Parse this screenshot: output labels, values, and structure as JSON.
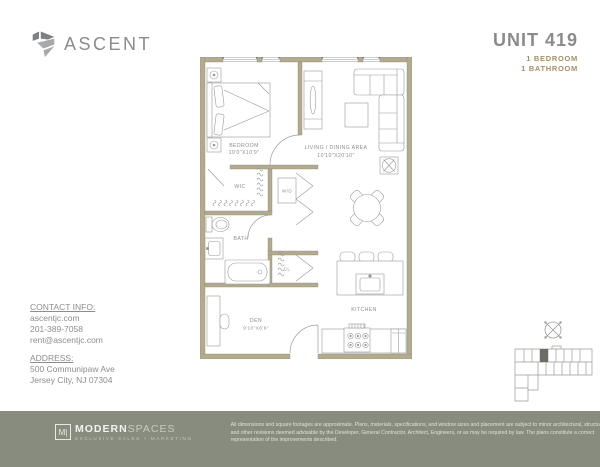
{
  "header": {
    "brand": "ASCENT",
    "unit": "UNIT 419",
    "detail_1": "1 BEDROOM",
    "detail_2": "1 BATHROOM"
  },
  "plan": {
    "rooms": {
      "bedroom": {
        "label": "BEDROOM",
        "dims": "10'0\"X10'9\""
      },
      "living": {
        "label": "LIVING / DINING AREA",
        "dims": "10'10\"X20'10\""
      },
      "wic": {
        "label": "WIC"
      },
      "wd": {
        "label": "W/D"
      },
      "bath": {
        "label": "BATH"
      },
      "cl": {
        "label": "CL"
      },
      "den": {
        "label": "DEN",
        "dims": "9'10\"X6'6\""
      },
      "kitchen": {
        "label": "KITCHEN"
      }
    }
  },
  "contact": {
    "heading": "CONTACT INFO:",
    "lines": [
      "ascentjc.com",
      "201-389-7058",
      "rent@ascentjc.com"
    ],
    "address_heading": "ADDRESS:",
    "address_lines": [
      "500 Communipaw Ave",
      "Jersey City, NJ 07304"
    ]
  },
  "footer": {
    "logo_m": "M|",
    "logo_bold": "MODERN",
    "logo_light": "SPACES",
    "logo_sub": "EXCLUSIVE SALES + MARKETING",
    "disclaimer_lines": [
      "All dimensions and square footages are approximate. Plans, materials, specifications, and window sizes and placement are subject to minor architectural, structural,",
      "and other revisions deemed advisable by the Developer, General Contractor, Architect, Engineers, or as may be required by law. The plans constitute a correct",
      "representation of the improvements described."
    ]
  },
  "colors": {
    "wall": "#b3ab8c",
    "accent_gold": "#a3916a",
    "footer_bg": "#878c7f",
    "text_gray": "#8c8d8f",
    "plan_line": "#97999c"
  }
}
